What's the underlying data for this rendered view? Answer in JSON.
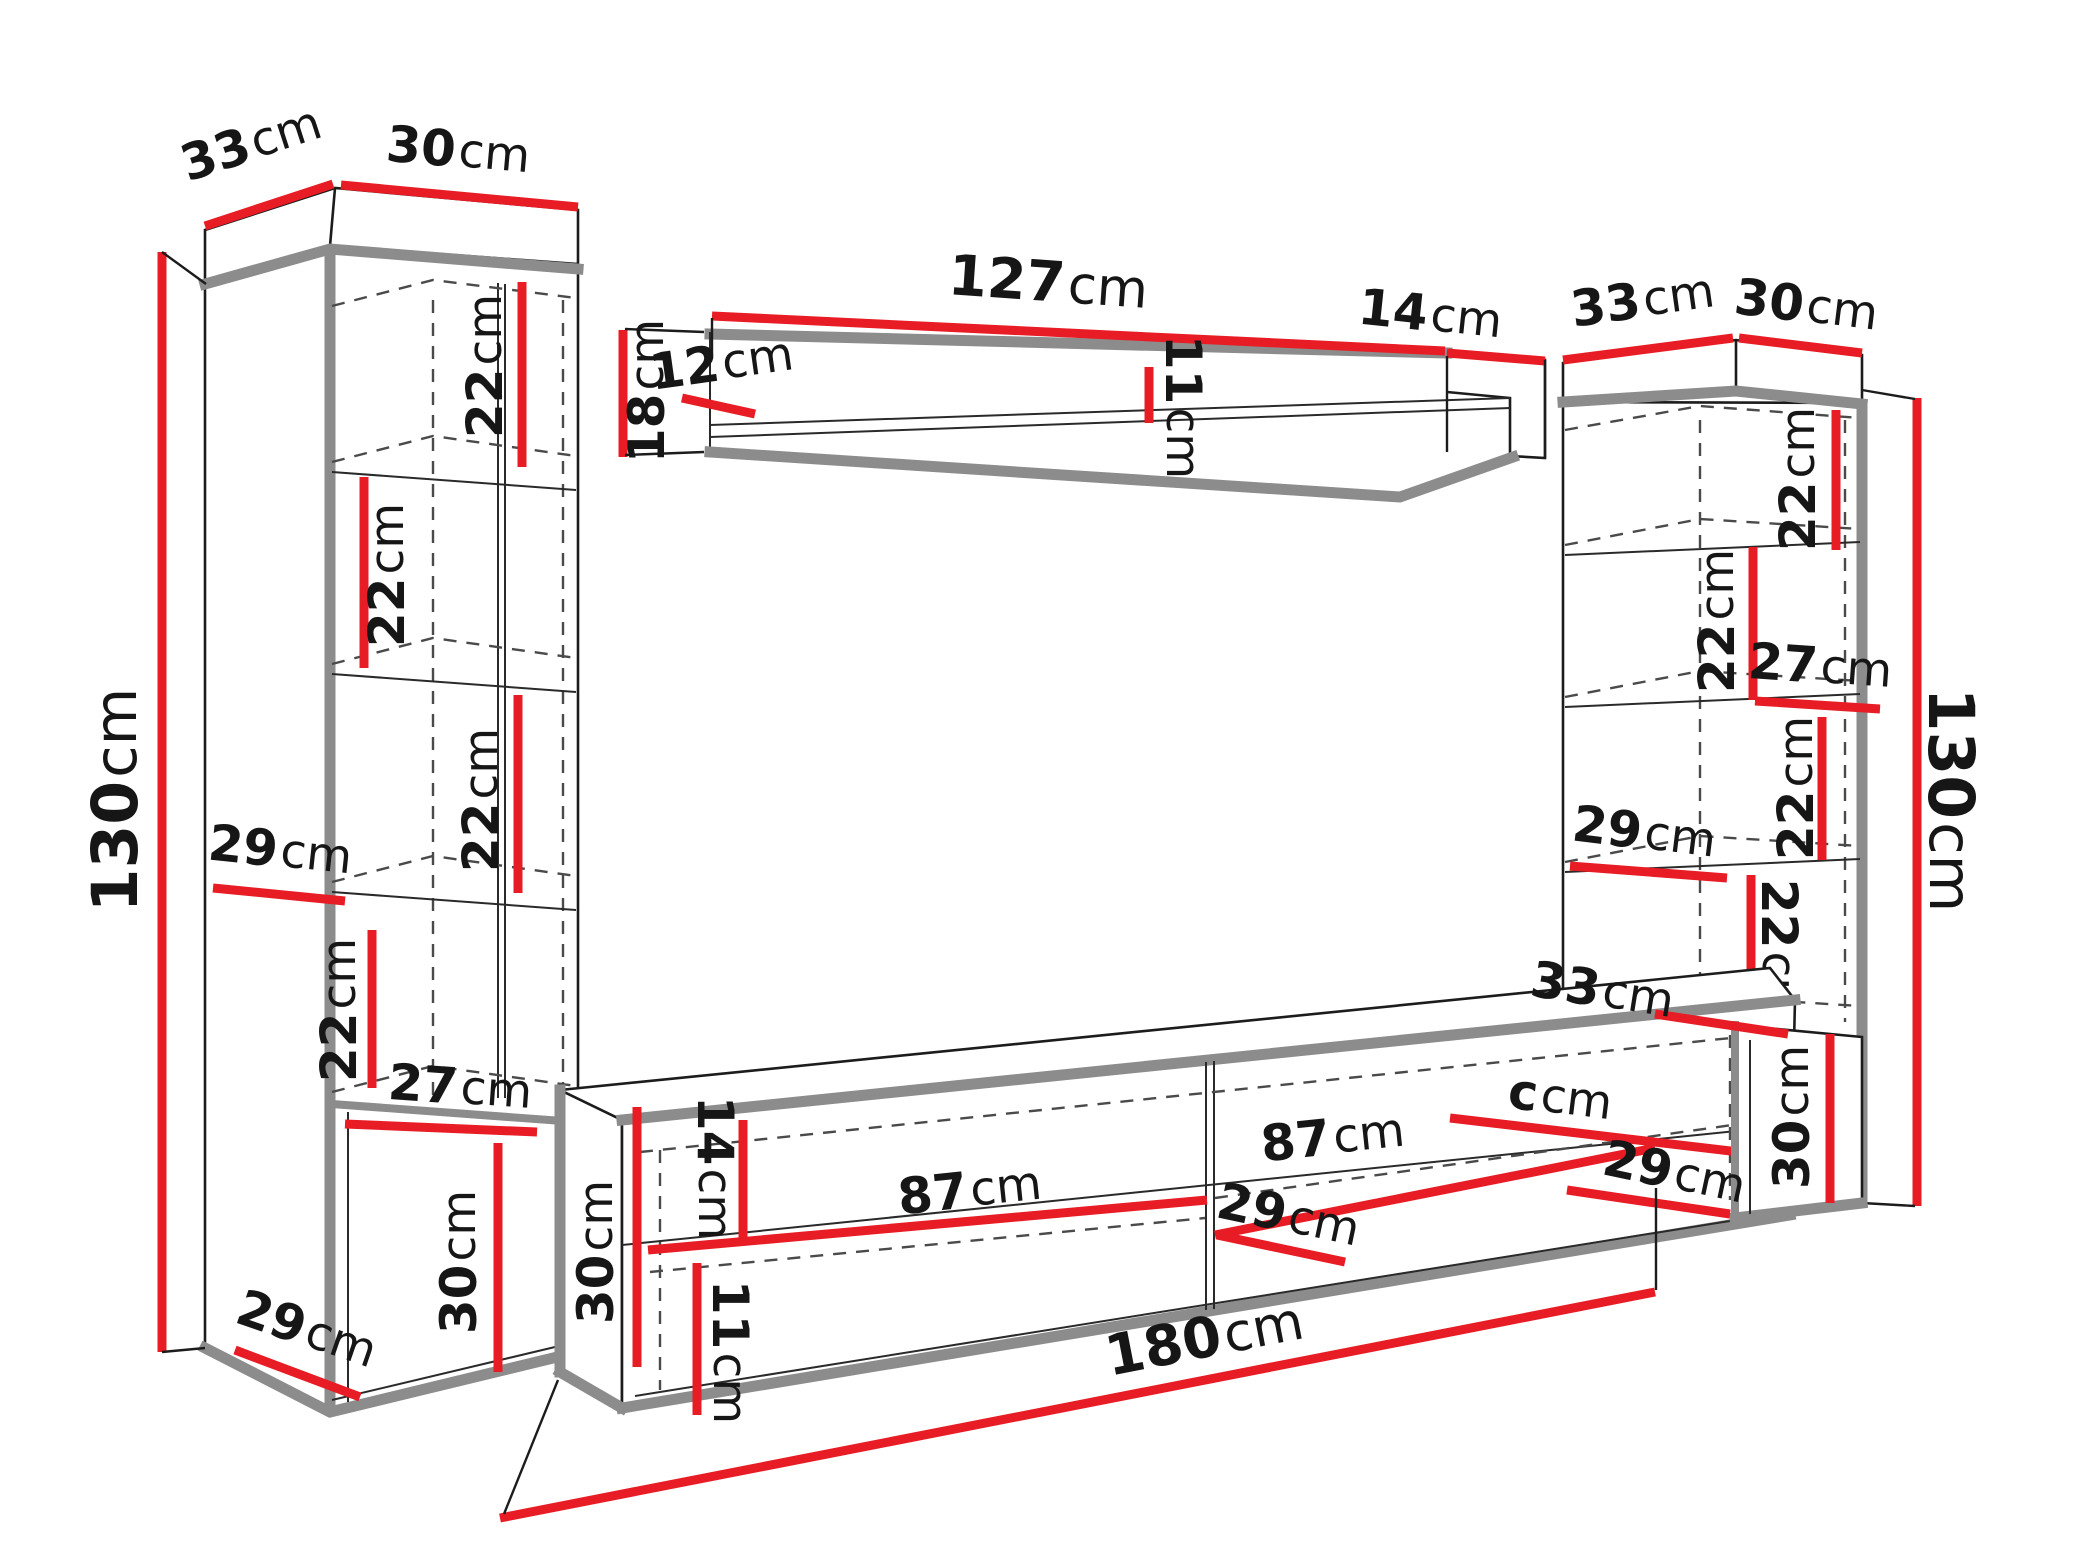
{
  "title": "wall-unit-furniture-dimension-diagram",
  "unit_suffix": "cm",
  "colors": {
    "dimension_red": "#e81c24",
    "edge_gray": "#8c8c8c",
    "line_black": "#1c1c1c",
    "background": "#ffffff"
  },
  "labels": {
    "lc_top_depth": {
      "v": "33",
      "u": "cm"
    },
    "lc_top_width": {
      "v": "30",
      "u": "cm"
    },
    "lc_height": {
      "v": "130",
      "u": "cm"
    },
    "lc_sec1": {
      "v": "22",
      "u": "cm"
    },
    "lc_sec2": {
      "v": "22",
      "u": "cm"
    },
    "lc_sec3": {
      "v": "22",
      "u": "cm"
    },
    "lc_shelf_depth": {
      "v": "29",
      "u": "cm"
    },
    "lc_sec4": {
      "v": "22",
      "u": "cm"
    },
    "lc_opening_width": {
      "v": "27",
      "u": "cm"
    },
    "lc_bottom_height": {
      "v": "30",
      "u": "cm"
    },
    "lc_bottom_depth": {
      "v": "29",
      "u": "cm"
    },
    "shelf_length": {
      "v": "127",
      "u": "cm"
    },
    "shelf_end_depth": {
      "v": "14",
      "u": "cm"
    },
    "shelf_height": {
      "v": "18",
      "u": "cm"
    },
    "shelf_inner_depth": {
      "v": "12",
      "u": "cm"
    },
    "shelf_inner_height": {
      "v": "11",
      "u": "cm"
    },
    "rc_top_depth": {
      "v": "33",
      "u": "cm"
    },
    "rc_top_width": {
      "v": "30",
      "u": "cm"
    },
    "rc_height": {
      "v": "130",
      "u": "cm"
    },
    "rc_sec1": {
      "v": "22",
      "u": "cm"
    },
    "rc_sec2": {
      "v": "22",
      "u": "cm"
    },
    "rc_opening_width": {
      "v": "27",
      "u": "cm"
    },
    "rc_shelf_depth": {
      "v": "29",
      "u": "cm"
    },
    "rc_sec3": {
      "v": "22",
      "u": "cm"
    },
    "rc_sec4": {
      "v": "22",
      "u": "cm"
    },
    "rc_bottom_top_depth": {
      "v": "33",
      "u": "cm"
    },
    "rc_bottom_height": {
      "v": "30",
      "u": "cm"
    },
    "rc_bottom_depth": {
      "v": "29",
      "u": "cm"
    },
    "ts_height": {
      "v": "30",
      "u": "cm"
    },
    "ts_front_height": {
      "v": "14",
      "u": "cm"
    },
    "ts_opening_height": {
      "v": "11",
      "u": "cm"
    },
    "ts_compartment_left": {
      "v": "87",
      "u": "cm"
    },
    "ts_compartment_right": {
      "v": "87",
      "u": "cm"
    },
    "ts_partial_dim": {
      "v": "c",
      "u": "cm"
    },
    "ts_shelf_depth": {
      "v": "29",
      "u": "cm"
    },
    "ts_length": {
      "v": "180",
      "u": "cm"
    }
  }
}
